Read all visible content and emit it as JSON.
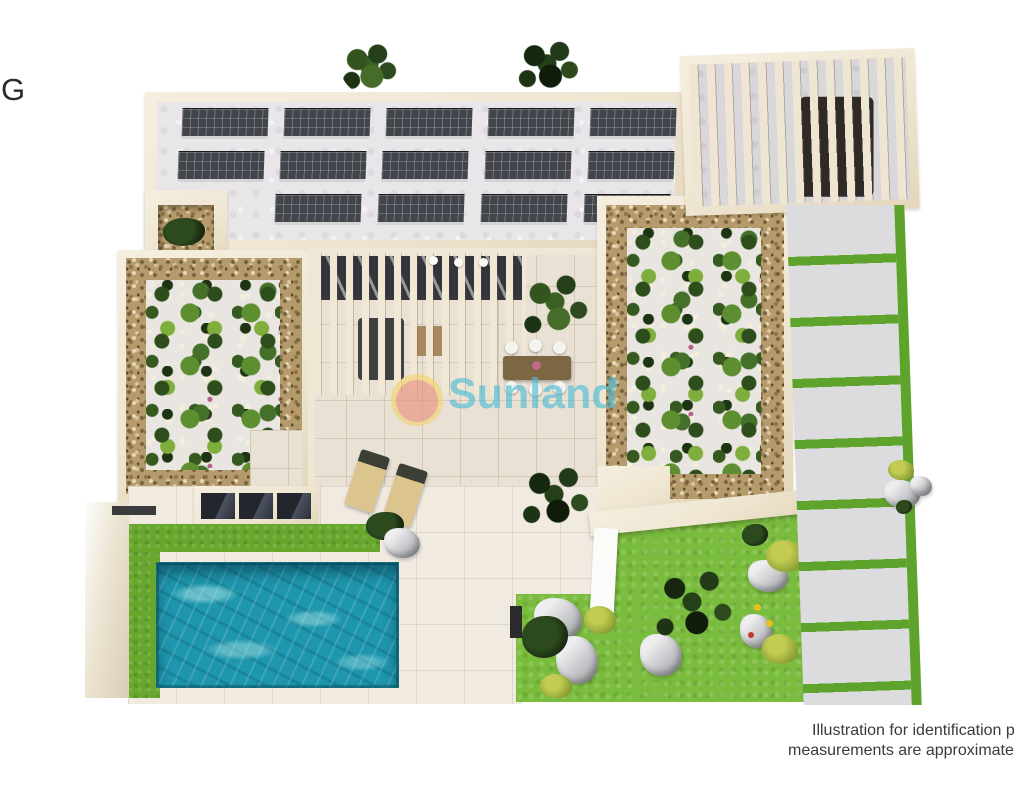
{
  "annotations": {
    "cropped_left_label": "G",
    "disclaimer_line1": "Illustration for identification p",
    "disclaimer_line2": "measurements are approximate"
  },
  "watermark": {
    "brand": "Sunland",
    "registered_mark": "®",
    "text_color": "#4fbcd4",
    "logo_ring_color": "#f2d36e",
    "logo_core_color": "#e9927f"
  },
  "palette": {
    "wall_cream": "#f1e9d7",
    "roof_concrete": "#e9e6ea",
    "solar_panel": "#42464c",
    "pergola_slat": "#eee6d2",
    "gravel": "#b59a6b",
    "plant_green": "#5d8f30",
    "flower_white": "#f3eed9",
    "flower_pink": "#b55f86",
    "grass_strip": "#68a72e",
    "lawn": "#7abc3e",
    "driveway_joint_green": "#5ea32c",
    "driveway_slab": "#dcdcde",
    "pool_water": "#1e96ad",
    "deck_tile": "#f0eae1",
    "patio_tile": "#e9e1d4",
    "disclaimer_text": "#3a3a3a"
  }
}
